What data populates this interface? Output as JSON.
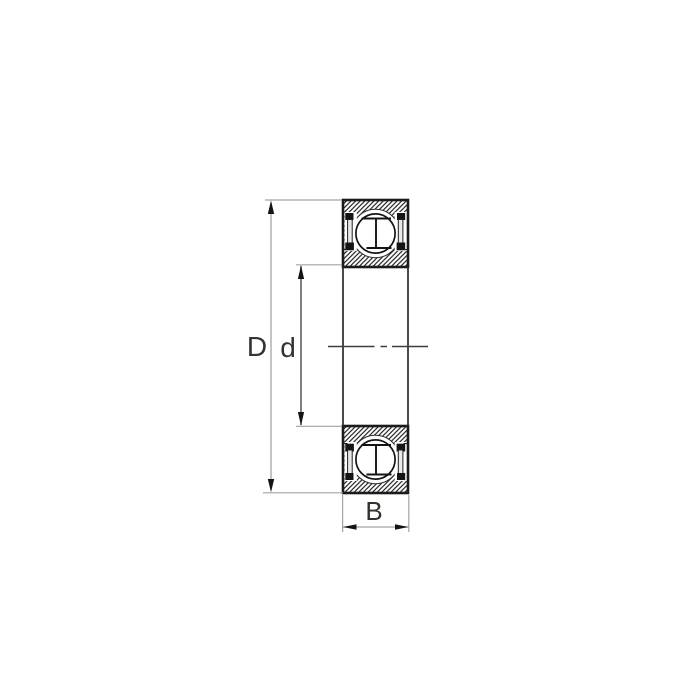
{
  "drawing": {
    "kind": "ball-bearing-cross-section",
    "background": "#ffffff",
    "labels": {
      "outer_diameter": "D",
      "bore_diameter": "d",
      "width": "B"
    },
    "colors": {
      "outline": "#1b1b1b",
      "extension_line": "#a3a3a3",
      "outer_dim_line": "#a3a3a3",
      "bore_dim_line": "#4a4a4a",
      "width_dim_line": "#a3a3a3",
      "centerline": "#3e3e3e",
      "arrow": "#141414",
      "label_text": "#35312c",
      "hatch_line": "#1b1b1b",
      "seal_fill": "#e9e9e9",
      "seal_cap": "#141414"
    }
  }
}
